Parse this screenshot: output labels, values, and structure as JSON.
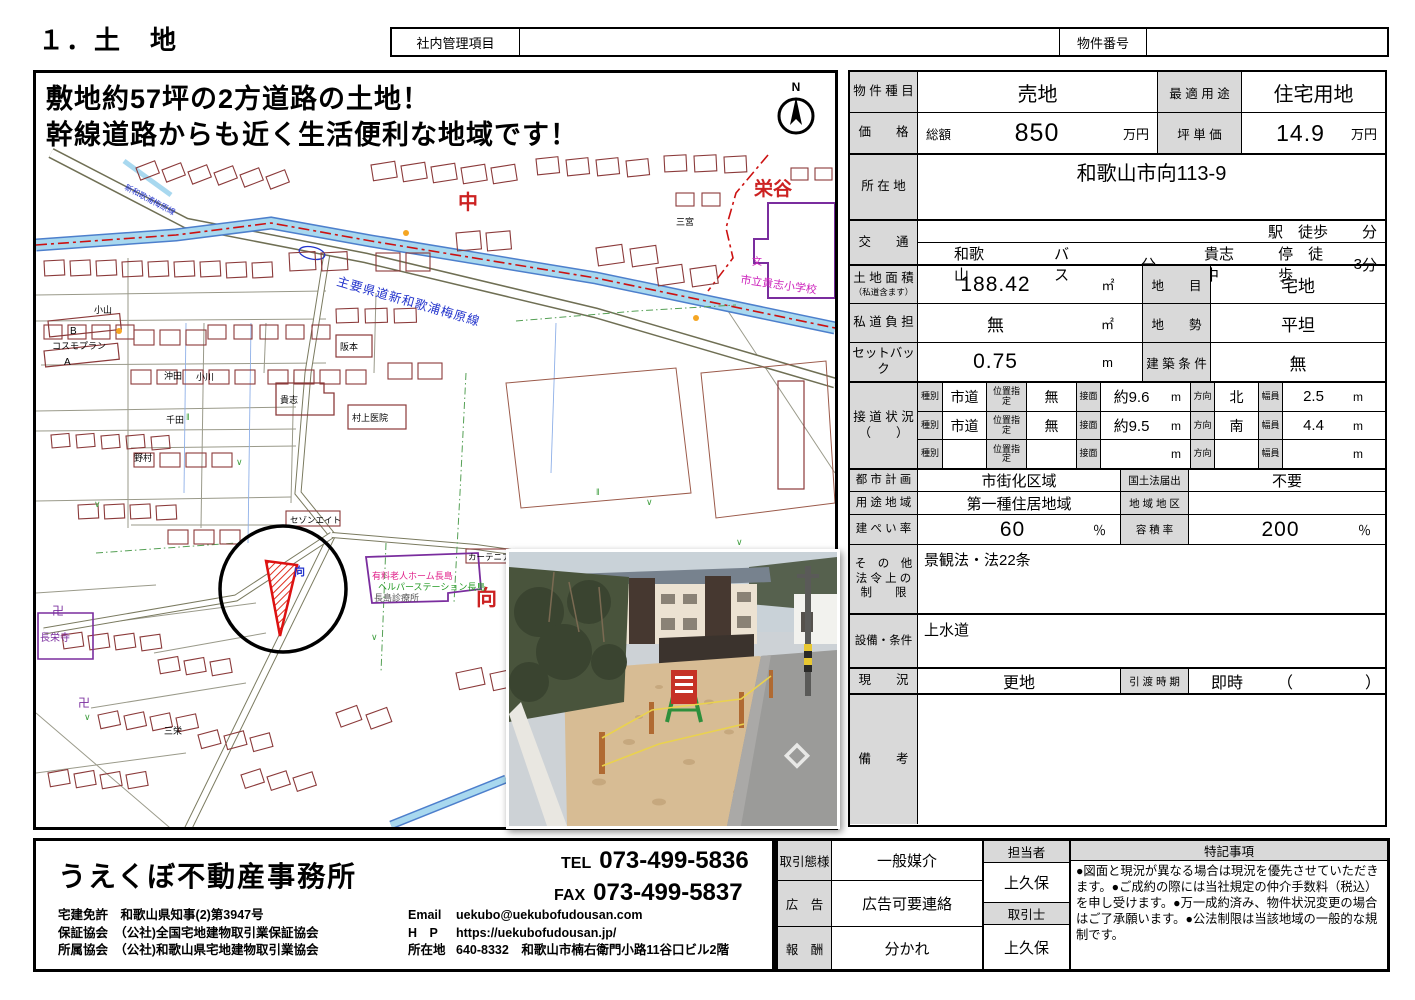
{
  "page": {
    "title": "１．土　地"
  },
  "header": {
    "internal_label": "社内管理項目",
    "property_no_label": "物件番号"
  },
  "map": {
    "catchphrase_line1": "敷地約57坪の2方道路の土地！",
    "catchphrase_line2": "幹線道路からも近く生活便利な地域です！",
    "compass_n": "N",
    "labels": {
      "naka": "中",
      "sakaedani": "栄谷",
      "mukai": "向",
      "mukai_small": "向",
      "school": "市立貴志小学校",
      "school_mark": "文",
      "road_main": "主要県道新和歌浦梅原線",
      "road_sub": "新和歌浦梅原線",
      "temple": "長栄寺",
      "manji": "卍",
      "manji2": "卍",
      "cosmo": "コスモプラン",
      "cosmo_a": "A",
      "cosmo_b": "B",
      "koyama": "小山",
      "okita": "沖田",
      "ogawa": "小川",
      "kishi": "貴志",
      "senda": "千田",
      "nomura": "野村",
      "sanei": "三栄",
      "sakamoto": "阪本",
      "murakami": "村上医院",
      "sannomiya": "三宮",
      "sezon": "セゾンエイト",
      "curtainia": "カーテニア",
      "nursing1": "有料老人ホーム長島",
      "nursing2": "ヘルパーステーション長島",
      "nursing3": "長島診療所"
    }
  },
  "table": {
    "r1": {
      "label": "物 件 種 目",
      "value": "売地",
      "label2": "最 適 用 途",
      "value2": "住宅用地"
    },
    "r2": {
      "label": "価　　格",
      "prefix": "総額",
      "value": "850",
      "unit": "万円",
      "label2": "坪 単 価",
      "value2": "14.9",
      "unit2": "万円"
    },
    "r3": {
      "label": "所 在 地",
      "value": "和歌山市向113-9"
    },
    "r4": {
      "label": "交　　通",
      "station": "駅　徒歩",
      "min1": "分",
      "bus_from": "和歌山",
      "bus": "バス",
      "min2": "分",
      "stop_name": "貴志中",
      "stop": "停　徒歩",
      "stop_min": "3",
      "min3": "分"
    },
    "r5": {
      "label": "土 地 面 積",
      "label_sub": "（私道含ます）",
      "value": "188.42",
      "unit": "㎡",
      "label2": "地　　目",
      "value2": "宅地"
    },
    "r6": {
      "label": "私 道 負 担",
      "value": "無",
      "unit": "㎡",
      "label2": "地　　勢",
      "value2": "平坦"
    },
    "r7": {
      "label": "セットバック",
      "value": "0.75",
      "unit": "m",
      "label2": "建 築 条 件",
      "value2": "無"
    },
    "r8": {
      "label": "接 道 状 況",
      "label_sub": "（　　）",
      "k": "種別",
      "p": "位置指定",
      "f": "接面",
      "d": "方向",
      "w": "幅員",
      "m": "m",
      "roads": [
        {
          "type": "市道",
          "pos": "無",
          "front": "約9.6",
          "dir": "北",
          "width": "2.5"
        },
        {
          "type": "市道",
          "pos": "無",
          "front": "約9.5",
          "dir": "南",
          "width": "4.4"
        },
        {
          "type": "",
          "pos": "",
          "front": "",
          "dir": "",
          "width": ""
        }
      ]
    },
    "r9": {
      "label": "都 市 計 画",
      "value": "市街化区域",
      "label2": "国土法届出",
      "value2": "不要"
    },
    "r10": {
      "label": "用 途 地 域",
      "value": "第一種住居地域",
      "label2": "地 域 地 区",
      "value2": ""
    },
    "r11": {
      "label": "建 ぺ い 率",
      "value": "60",
      "unit": "％",
      "label2": "容 積 率",
      "value2": "200",
      "unit2": "％"
    },
    "r12": {
      "label1": "そ　の　他",
      "label2": "法 令 上 の",
      "label3": "制　　限",
      "value": "景観法・法22条"
    },
    "r13": {
      "label": "設備・条件",
      "value": "上水道"
    },
    "r14": {
      "label": "現　　況",
      "value": "更地",
      "label2": "引 渡 時 期",
      "value2": "即時",
      "paren_open": "（",
      "paren_close": "）"
    },
    "r15": {
      "label": "備　　考",
      "value": ""
    }
  },
  "agency": {
    "name": "うえくぼ不動産事務所",
    "tel_label": "TEL",
    "tel": "073-499-5836",
    "fax_label": "FAX",
    "fax": "073-499-5837",
    "license_label": "宅建免許",
    "license": "和歌山県知事(2)第3947号",
    "guarantee_label": "保証協会",
    "guarantee": "（公社)全国宅地建物取引業保証協会",
    "assoc_label": "所属協会",
    "assoc": "（公社)和歌山県宅地建物取引業協会",
    "email_label": "Email",
    "email": "uekubo@uekubofudousan.com",
    "hp_label": "H　P",
    "hp": "https://uekubofudousan.jp/",
    "addr_label": "所在地",
    "addr": "640-8332　和歌山市楠右衛門小路11谷口ビル2階"
  },
  "deal": {
    "style_label": "取引態様",
    "style": "一般媒介",
    "ad_label": "広　告",
    "ad": "広告可要連絡",
    "fee_label": "報　酬",
    "fee": "分かれ",
    "staff_label": "担当者",
    "staff": "上久保",
    "agent_label": "取引士",
    "agent": "上久保",
    "notes_label": "特記事項",
    "notes": "●図面と現況が異なる場合は現況を優先させていただきます。●ご成約の際には当社規定の仲介手数料（税込）を申し受けます。●万一成約済み、物件状況変更の場合はご了承願います。●公法制限は当該地域の一般的な規制です。"
  }
}
